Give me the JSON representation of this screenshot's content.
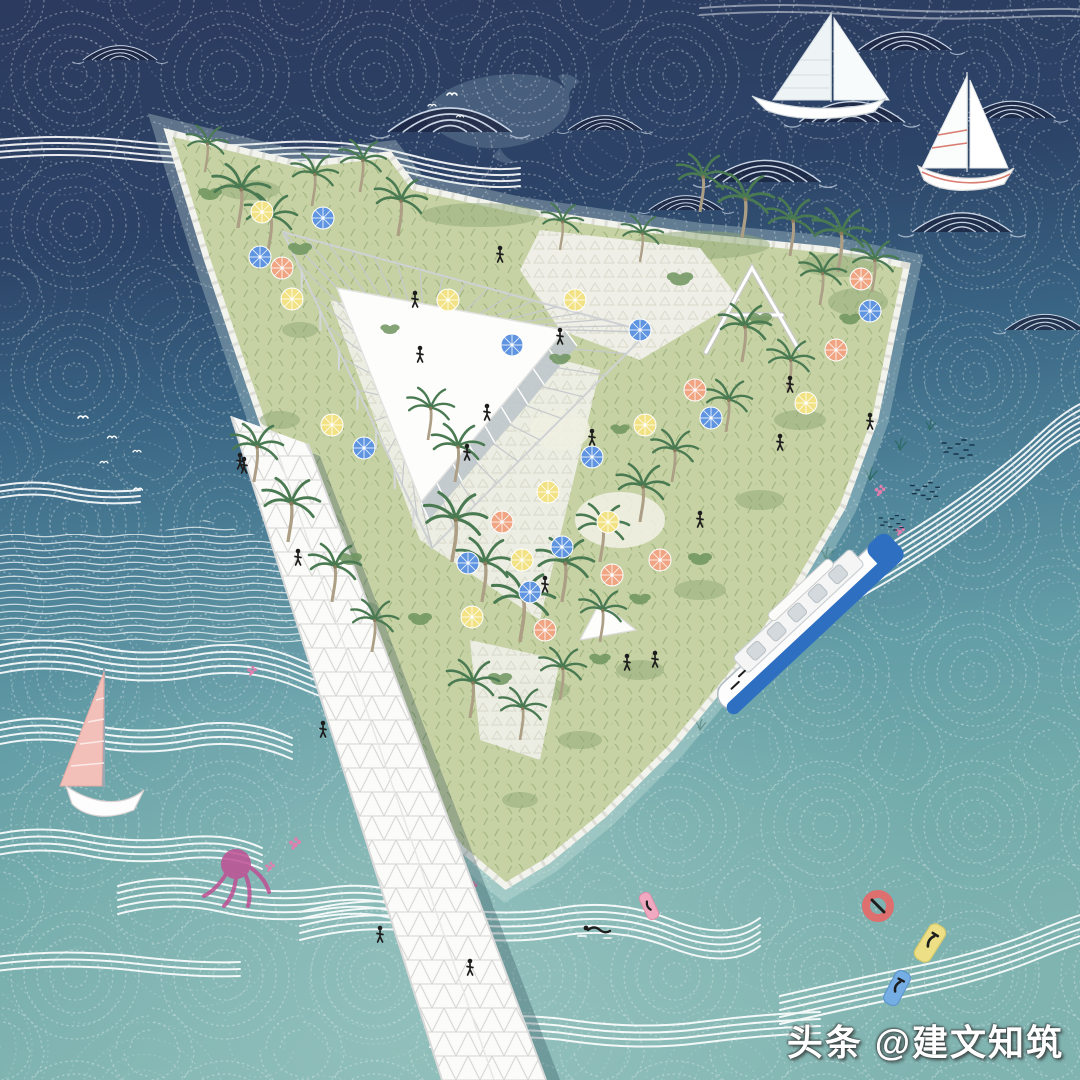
{
  "meta": {
    "title": "Aerial illustration of a triangular floating island park",
    "style": "hand-stitched wave texture architectural rendering"
  },
  "watermark": {
    "text": "头条 @建文知筑"
  },
  "palette": {
    "water_top": "#2b3a5e",
    "water_mid": "#46738f",
    "water_lower": "#649da6",
    "water_bottom": "#80b4b1",
    "stitch": "#ffffff",
    "mound_line": "#c9d4e4",
    "wave_line": "#ffffff",
    "island_grass": "#c6d2a4",
    "grass_dark": "#9fb37c",
    "paving": "#f1f1ea",
    "paving_grid": "#d9d9cd",
    "structure_white": "#fdfdfc",
    "structure_gray": "#c6c9cc",
    "glass_gray": "#bfc8ce",
    "palm_green": "#4a7a52",
    "palm_trunk": "#ac9f85",
    "bush_green": "#6f955f",
    "umbrella_yellow": "#f2e283",
    "umbrella_blue": "#5e94e0",
    "umbrella_salmon": "#f0a482",
    "ferry_blue": "#2e6fc2",
    "sail_pink": "#f2c0b9",
    "sail_stripe_red": "#d97f72",
    "whale": "#5f7691",
    "figure": "#1d1d1d",
    "coral": "#e07fae",
    "octopus": "#bf4f93",
    "seaweed": "#2f6b66",
    "fish": "#17344a",
    "ring_red": "#dd6f6f",
    "float_yellow": "#ecdf86",
    "float_blue": "#74aee4",
    "float_pink": "#f0a9c0"
  },
  "scene": {
    "wave_mounds": [
      {
        "x": 450,
        "y": 132,
        "s": 1
      },
      {
        "x": 765,
        "y": 182,
        "s": 0.9
      },
      {
        "x": 852,
        "y": 122,
        "s": 0.85
      },
      {
        "x": 905,
        "y": 50,
        "s": 0.75
      },
      {
        "x": 1012,
        "y": 118,
        "s": 0.7
      },
      {
        "x": 962,
        "y": 232,
        "s": 0.8
      },
      {
        "x": 605,
        "y": 130,
        "s": 0.6
      },
      {
        "x": 686,
        "y": 210,
        "s": 0.6
      },
      {
        "x": 120,
        "y": 60,
        "s": 0.6
      },
      {
        "x": 1045,
        "y": 330,
        "s": 0.65
      }
    ],
    "birds": [
      {
        "x": 452,
        "y": 95,
        "s": 1
      },
      {
        "x": 432,
        "y": 106,
        "s": 0.8
      },
      {
        "x": 460,
        "y": 117,
        "s": 0.7
      },
      {
        "x": 83,
        "y": 418,
        "s": 1
      },
      {
        "x": 112,
        "y": 438,
        "s": 0.9
      },
      {
        "x": 137,
        "y": 452,
        "s": 0.8
      },
      {
        "x": 104,
        "y": 463,
        "s": 0.8
      },
      {
        "x": 138,
        "y": 490,
        "s": 0.9
      }
    ],
    "palms": [
      {
        "x": 238,
        "y": 228,
        "s": 1.1
      },
      {
        "x": 268,
        "y": 252,
        "s": 1.0
      },
      {
        "x": 312,
        "y": 206,
        "s": 0.9
      },
      {
        "x": 360,
        "y": 192,
        "s": 0.9
      },
      {
        "x": 398,
        "y": 236,
        "s": 1.0
      },
      {
        "x": 700,
        "y": 212,
        "s": 1.0
      },
      {
        "x": 742,
        "y": 238,
        "s": 1.1
      },
      {
        "x": 790,
        "y": 256,
        "s": 1.0
      },
      {
        "x": 838,
        "y": 272,
        "s": 1.1
      },
      {
        "x": 872,
        "y": 292,
        "s": 0.9
      },
      {
        "x": 820,
        "y": 305,
        "s": 0.9
      },
      {
        "x": 640,
        "y": 262,
        "s": 0.8
      },
      {
        "x": 254,
        "y": 482,
        "s": 1.0
      },
      {
        "x": 288,
        "y": 542,
        "s": 1.1
      },
      {
        "x": 332,
        "y": 602,
        "s": 1.0
      },
      {
        "x": 372,
        "y": 652,
        "s": 0.9
      },
      {
        "x": 452,
        "y": 562,
        "s": 1.2
      },
      {
        "x": 482,
        "y": 602,
        "s": 1.1
      },
      {
        "x": 520,
        "y": 642,
        "s": 1.2
      },
      {
        "x": 562,
        "y": 602,
        "s": 1.1
      },
      {
        "x": 600,
        "y": 562,
        "s": 1.0
      },
      {
        "x": 640,
        "y": 522,
        "s": 1.0
      },
      {
        "x": 672,
        "y": 482,
        "s": 0.9
      },
      {
        "x": 470,
        "y": 718,
        "s": 1.0
      },
      {
        "x": 520,
        "y": 740,
        "s": 0.9
      },
      {
        "x": 560,
        "y": 700,
        "s": 0.9
      },
      {
        "x": 455,
        "y": 482,
        "s": 1.0
      },
      {
        "x": 428,
        "y": 440,
        "s": 0.9
      },
      {
        "x": 600,
        "y": 642,
        "s": 0.9
      },
      {
        "x": 742,
        "y": 362,
        "s": 1.0
      },
      {
        "x": 788,
        "y": 392,
        "s": 0.9
      },
      {
        "x": 726,
        "y": 432,
        "s": 0.9
      },
      {
        "x": 205,
        "y": 172,
        "s": 0.8
      },
      {
        "x": 560,
        "y": 250,
        "s": 0.8
      }
    ],
    "bushes": [
      {
        "x": 210,
        "y": 195,
        "s": 1
      },
      {
        "x": 300,
        "y": 250,
        "s": 1
      },
      {
        "x": 680,
        "y": 280,
        "s": 1.1
      },
      {
        "x": 760,
        "y": 320,
        "s": 1
      },
      {
        "x": 850,
        "y": 320,
        "s": 0.9
      },
      {
        "x": 350,
        "y": 560,
        "s": 1
      },
      {
        "x": 420,
        "y": 620,
        "s": 1
      },
      {
        "x": 500,
        "y": 680,
        "s": 1
      },
      {
        "x": 600,
        "y": 660,
        "s": 0.9
      },
      {
        "x": 700,
        "y": 560,
        "s": 1
      },
      {
        "x": 640,
        "y": 600,
        "s": 0.9
      },
      {
        "x": 560,
        "y": 360,
        "s": 0.9
      },
      {
        "x": 390,
        "y": 330,
        "s": 0.8
      },
      {
        "x": 620,
        "y": 430,
        "s": 0.8
      }
    ],
    "umbrellas": [
      {
        "x": 262,
        "y": 212,
        "color": "yellow"
      },
      {
        "x": 292,
        "y": 299,
        "color": "yellow"
      },
      {
        "x": 332,
        "y": 425,
        "color": "yellow"
      },
      {
        "x": 448,
        "y": 300,
        "color": "yellow"
      },
      {
        "x": 575,
        "y": 300,
        "color": "yellow"
      },
      {
        "x": 645,
        "y": 425,
        "color": "yellow"
      },
      {
        "x": 548,
        "y": 492,
        "color": "yellow"
      },
      {
        "x": 608,
        "y": 522,
        "color": "yellow"
      },
      {
        "x": 806,
        "y": 403,
        "color": "yellow"
      },
      {
        "x": 472,
        "y": 617,
        "color": "yellow"
      },
      {
        "x": 522,
        "y": 560,
        "color": "yellow"
      },
      {
        "x": 323,
        "y": 218,
        "color": "blue"
      },
      {
        "x": 260,
        "y": 257,
        "color": "blue"
      },
      {
        "x": 364,
        "y": 448,
        "color": "blue"
      },
      {
        "x": 512,
        "y": 345,
        "color": "blue"
      },
      {
        "x": 640,
        "y": 330,
        "color": "blue"
      },
      {
        "x": 592,
        "y": 457,
        "color": "blue"
      },
      {
        "x": 562,
        "y": 547,
        "color": "blue"
      },
      {
        "x": 870,
        "y": 311,
        "color": "blue"
      },
      {
        "x": 711,
        "y": 418,
        "color": "blue"
      },
      {
        "x": 530,
        "y": 592,
        "color": "blue"
      },
      {
        "x": 468,
        "y": 563,
        "color": "blue"
      },
      {
        "x": 282,
        "y": 268,
        "color": "salmon"
      },
      {
        "x": 695,
        "y": 390,
        "color": "salmon"
      },
      {
        "x": 502,
        "y": 522,
        "color": "salmon"
      },
      {
        "x": 861,
        "y": 279,
        "color": "salmon"
      },
      {
        "x": 545,
        "y": 630,
        "color": "salmon"
      },
      {
        "x": 660,
        "y": 560,
        "color": "salmon"
      },
      {
        "x": 612,
        "y": 575,
        "color": "salmon"
      },
      {
        "x": 836,
        "y": 350,
        "color": "salmon"
      }
    ],
    "people": [
      {
        "x": 500,
        "y": 255
      },
      {
        "x": 560,
        "y": 337
      },
      {
        "x": 487,
        "y": 413
      },
      {
        "x": 467,
        "y": 453
      },
      {
        "x": 420,
        "y": 355
      },
      {
        "x": 592,
        "y": 438
      },
      {
        "x": 790,
        "y": 385
      },
      {
        "x": 780,
        "y": 443
      },
      {
        "x": 870,
        "y": 422
      },
      {
        "x": 655,
        "y": 660
      },
      {
        "x": 627,
        "y": 663
      },
      {
        "x": 700,
        "y": 520
      },
      {
        "x": 545,
        "y": 585
      },
      {
        "x": 415,
        "y": 300
      },
      {
        "x": 240,
        "y": 462
      },
      {
        "x": 244,
        "y": 466
      },
      {
        "x": 298,
        "y": 558
      },
      {
        "x": 323,
        "y": 730
      },
      {
        "x": 380,
        "y": 935
      },
      {
        "x": 470,
        "y": 968
      }
    ],
    "seaweed": [
      {
        "x": 540,
        "y": 800,
        "s": 1
      },
      {
        "x": 578,
        "y": 772,
        "s": 1
      },
      {
        "x": 618,
        "y": 742,
        "s": 0.9
      },
      {
        "x": 662,
        "y": 708,
        "s": 1
      },
      {
        "x": 706,
        "y": 672,
        "s": 0.9
      },
      {
        "x": 748,
        "y": 636,
        "s": 1
      },
      {
        "x": 788,
        "y": 598,
        "s": 0.9
      },
      {
        "x": 826,
        "y": 560,
        "s": 1
      },
      {
        "x": 700,
        "y": 730,
        "s": 0.8
      },
      {
        "x": 650,
        "y": 770,
        "s": 0.8
      },
      {
        "x": 600,
        "y": 800,
        "s": 0.8
      },
      {
        "x": 870,
        "y": 480,
        "s": 1
      },
      {
        "x": 900,
        "y": 450,
        "s": 0.9
      },
      {
        "x": 560,
        "y": 830,
        "s": 0.8
      },
      {
        "x": 520,
        "y": 860,
        "s": 0.8
      },
      {
        "x": 930,
        "y": 430,
        "s": 0.8
      }
    ],
    "corals": [
      {
        "x": 770,
        "y": 565,
        "s": 1
      },
      {
        "x": 795,
        "y": 545,
        "s": 0.8
      },
      {
        "x": 610,
        "y": 790,
        "s": 1
      },
      {
        "x": 645,
        "y": 762,
        "s": 0.9
      },
      {
        "x": 533,
        "y": 835,
        "s": 1
      },
      {
        "x": 505,
        "y": 856,
        "s": 0.9
      },
      {
        "x": 568,
        "y": 815,
        "s": 0.8
      },
      {
        "x": 472,
        "y": 888,
        "s": 0.9
      },
      {
        "x": 295,
        "y": 845,
        "s": 1
      },
      {
        "x": 270,
        "y": 868,
        "s": 0.8
      },
      {
        "x": 252,
        "y": 672,
        "s": 0.8
      },
      {
        "x": 880,
        "y": 492,
        "s": 0.9
      },
      {
        "x": 900,
        "y": 532,
        "s": 0.8
      }
    ],
    "fish_schools": [
      {
        "x": 948,
        "y": 448,
        "s": 1
      },
      {
        "x": 916,
        "y": 490,
        "s": 0.9
      },
      {
        "x": 884,
        "y": 522,
        "s": 0.8
      },
      {
        "x": 753,
        "y": 587,
        "s": 0.8
      },
      {
        "x": 700,
        "y": 648,
        "s": 0.7
      }
    ]
  }
}
